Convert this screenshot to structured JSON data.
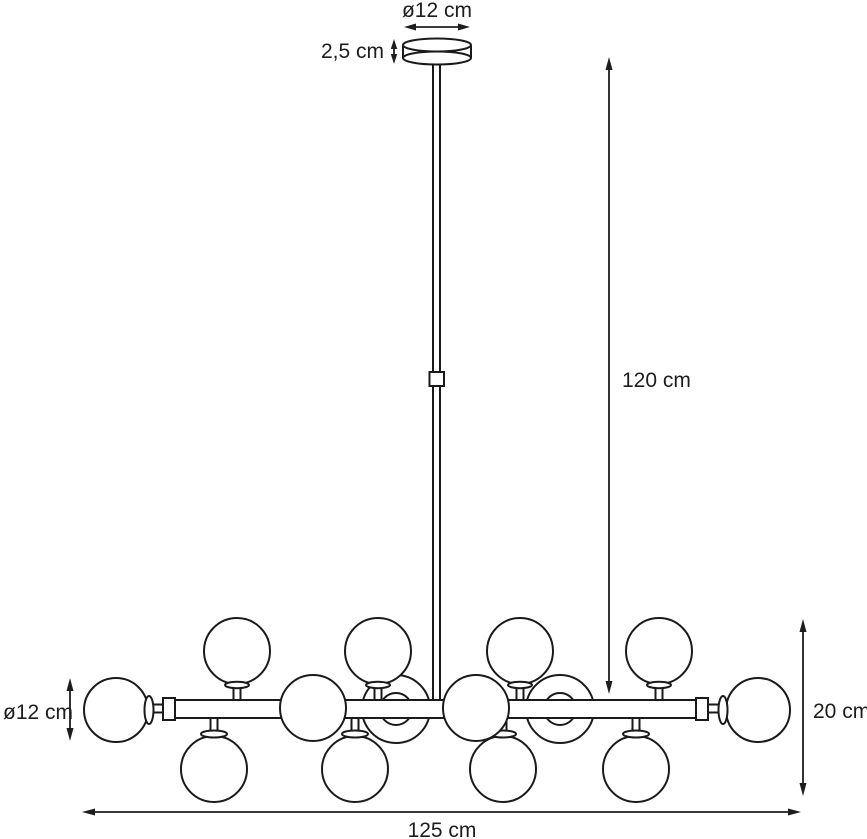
{
  "diagram": {
    "kind": "dimension-drawing",
    "background_color": "#ffffff",
    "line_color": "#1a1a1a",
    "text_color": "#1d1d1b",
    "dimensions": {
      "canopy_diameter": "ø12 cm",
      "canopy_height": "2,5 cm",
      "suspension_drop": "120 cm",
      "shade_diameter": "ø12 cm",
      "fixture_height": "20 cm",
      "fixture_width": "125 cm"
    },
    "shade_count": {
      "total": 14,
      "top_row": 4,
      "bottom_row": 4,
      "front": 2,
      "back": 2,
      "ends": 2
    }
  }
}
